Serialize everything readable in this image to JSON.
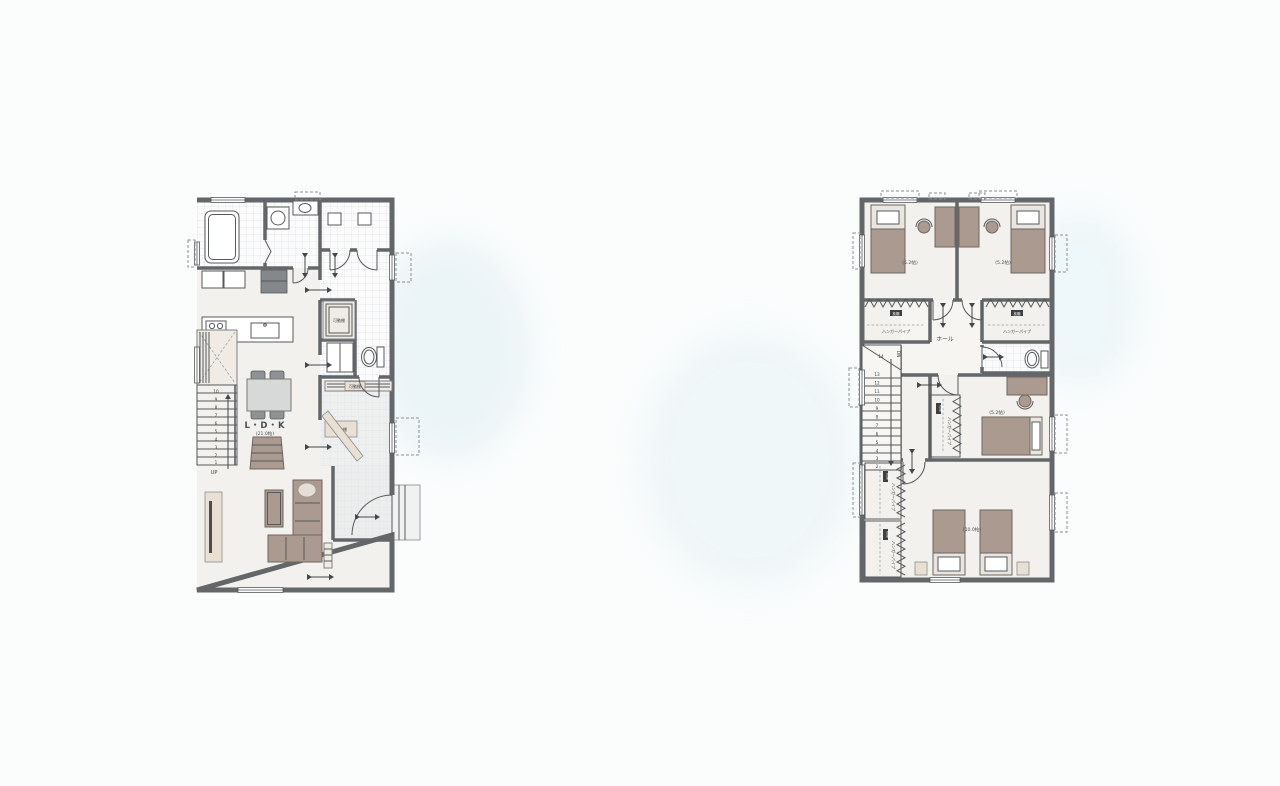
{
  "page": {
    "background_color": "#fbfdfd"
  },
  "colors": {
    "wall": "#63676a",
    "floor": "#f3f1ed",
    "wet_floor": "#fafbfa",
    "wood_furniture": "#ab9a90",
    "beige_accent": "#e9dfd3",
    "label_text": "#3b3e41"
  },
  "floor1": {
    "name": "1st-floor-plan",
    "ldk_label": "L・D・K",
    "ldk_size": "(21.0帖)",
    "movable_shelf_label": "可動棚",
    "stairs_up_label": "UP",
    "stair_numbers": [
      "1",
      "2",
      "3",
      "4",
      "5",
      "6",
      "7",
      "8",
      "9",
      "10"
    ]
  },
  "floor2": {
    "name": "2nd-floor-plan",
    "hall_label": "ホール",
    "stairs_down_label": "DN",
    "stair_top_step": "14",
    "stair_numbers": [
      "2",
      "3",
      "4",
      "5",
      "6",
      "7",
      "8",
      "9",
      "10",
      "11",
      "12",
      "13"
    ],
    "bedroom_size_small": "(5.2帖)",
    "bedroom_size_large": "(10.0帖)",
    "hanger_pipe_label": "ハンガーパイプ",
    "pillow_shelf_label": "枕棚"
  }
}
